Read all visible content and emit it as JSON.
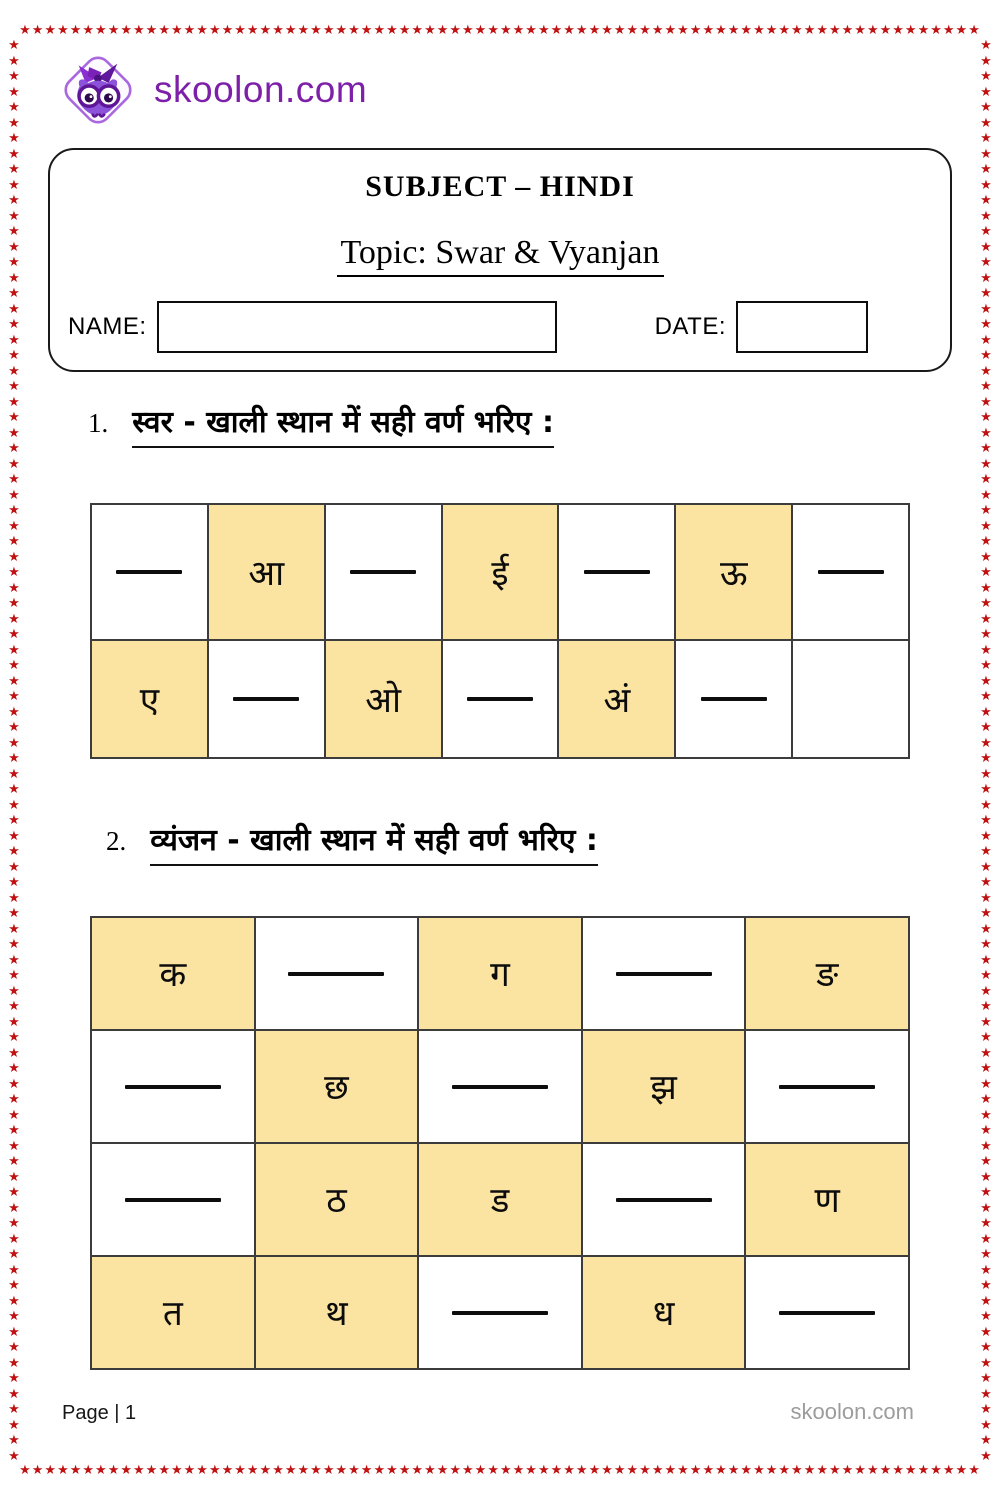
{
  "border_decoration": {
    "star": "★",
    "color": "#c01212"
  },
  "brand": {
    "site": "skoolon.com"
  },
  "header": {
    "subject": "SUBJECT – HINDI",
    "topic": "Topic: Swar & Vyanjan",
    "name_label": "NAME:",
    "name_value": "",
    "date_label": "DATE:",
    "date_value": ""
  },
  "questions": [
    {
      "number": "1.",
      "title": "स्वर - खाली स्थान में सही वर्ण भरिए :",
      "rows": [
        [
          {
            "blank": true
          },
          {
            "letter": "आ",
            "highlight": true
          },
          {
            "blank": true
          },
          {
            "letter": "ई",
            "highlight": true
          },
          {
            "blank": true
          },
          {
            "letter": "ऊ",
            "highlight": true
          },
          {
            "blank": true
          }
        ],
        [
          {
            "letter": "ए",
            "highlight": true
          },
          {
            "blank": true
          },
          {
            "letter": "ओ",
            "highlight": true
          },
          {
            "blank": true
          },
          {
            "letter": "अं",
            "highlight": true
          },
          {
            "blank": true
          },
          {}
        ]
      ]
    },
    {
      "number": "2.",
      "title": "व्यंजन - खाली स्थान में सही वर्ण भरिए :",
      "rows": [
        [
          {
            "letter": "क",
            "highlight": true
          },
          {
            "blank": true
          },
          {
            "letter": "ग",
            "highlight": true
          },
          {
            "blank": true
          },
          {
            "letter": "ङ",
            "highlight": true
          }
        ],
        [
          {
            "blank": true
          },
          {
            "letter": "छ",
            "highlight": true
          },
          {
            "blank": true
          },
          {
            "letter": "झ",
            "highlight": true
          },
          {
            "blank": true
          }
        ],
        [
          {
            "blank": true
          },
          {
            "letter": "ठ",
            "highlight": true
          },
          {
            "letter": "ड",
            "highlight": true
          },
          {
            "blank": true
          },
          {
            "letter": "ण",
            "highlight": true
          }
        ],
        [
          {
            "letter": "त",
            "highlight": true
          },
          {
            "letter": "थ",
            "highlight": true
          },
          {
            "blank": true
          },
          {
            "letter": "ध",
            "highlight": true
          },
          {
            "blank": true
          }
        ]
      ]
    }
  ],
  "footer": {
    "page_label": "Page | 1",
    "site": "skoolon.com"
  },
  "colors": {
    "highlight_yellow": "#fbe3a2",
    "star_red": "#c01212",
    "brand_purple": "#7d1fa8",
    "grid_line": "#3c3c3c"
  }
}
